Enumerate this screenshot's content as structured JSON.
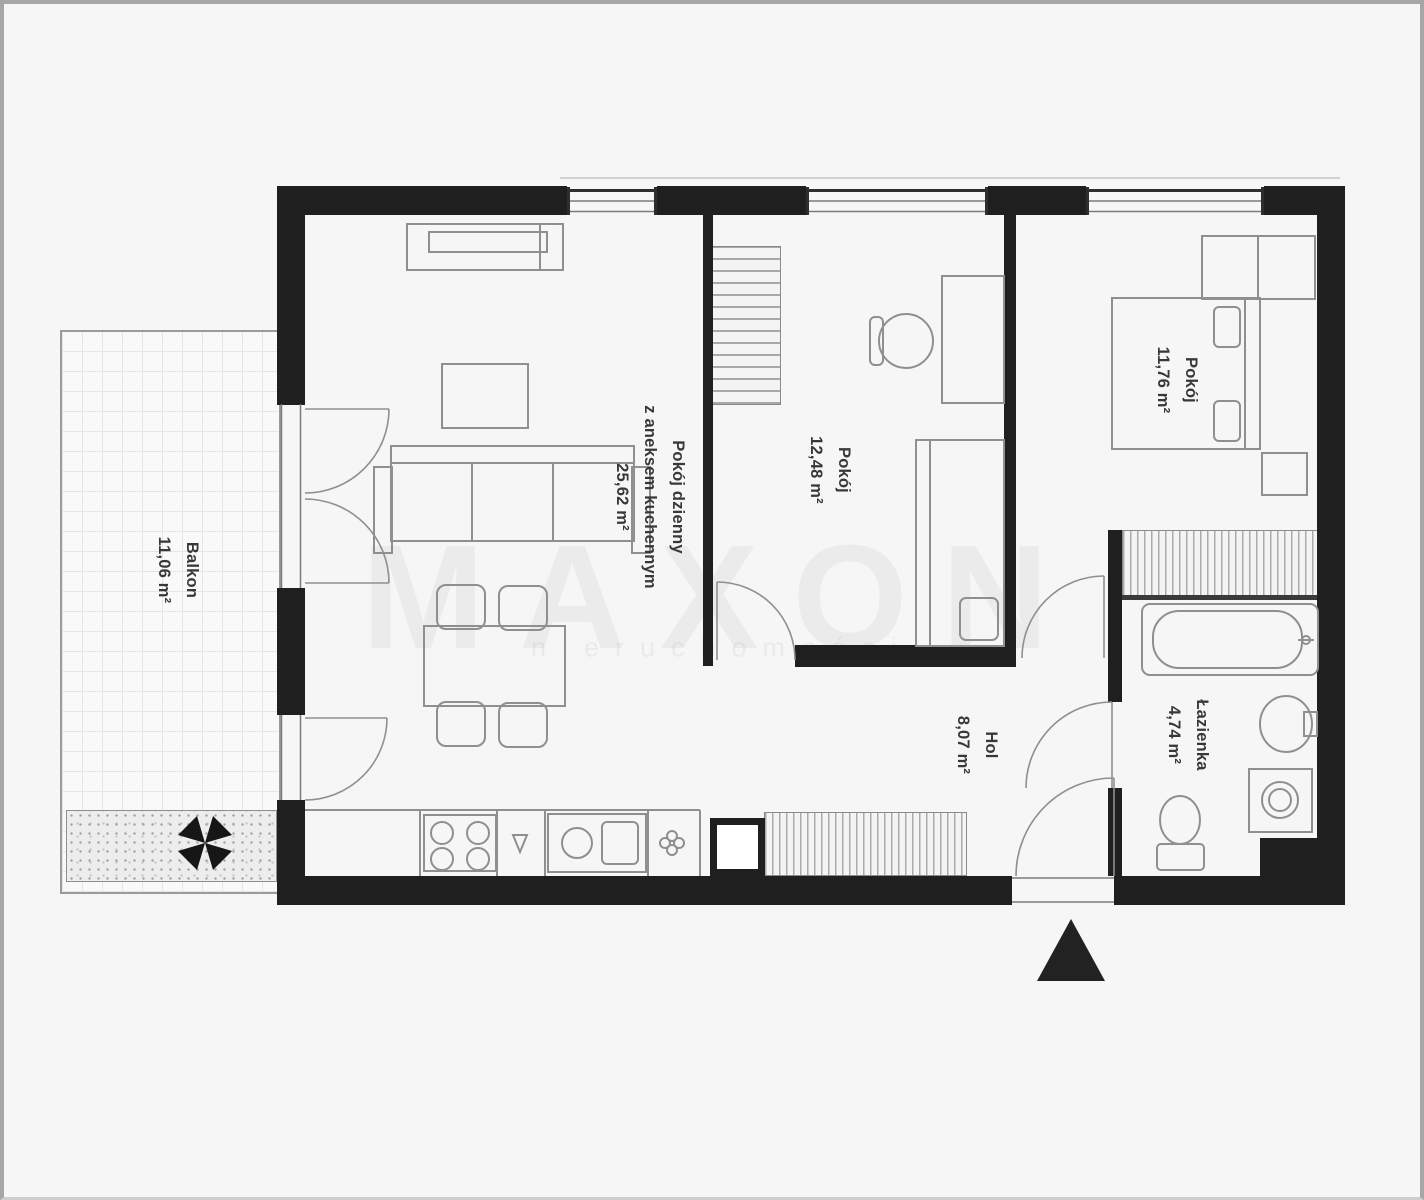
{
  "colors": {
    "wall": "#1f1f1f",
    "furniture_line": "#8f8f8f",
    "label_text": "#383838",
    "frame_border": "#a6a6a6",
    "background": "#f6f6f7"
  },
  "rooms": {
    "living": {
      "line1": "Pokój dzienny",
      "line2": "z aneksem kuchennym",
      "area": "25,62 m²"
    },
    "room2": {
      "line1": "Pokój",
      "area": "12,48 m²"
    },
    "bedroom": {
      "line1": "Pokój",
      "area": "11,76 m²"
    },
    "hall": {
      "line1": "Hol",
      "area": "8,07 m²"
    },
    "bathroom": {
      "line1": "Łazienka",
      "area": "4,74 m²"
    },
    "balcony": {
      "line1": "Balkon",
      "area": "11,06 m²"
    }
  },
  "watermark": {
    "brand": "MAXON",
    "sub": "nieruchomości"
  },
  "icons": {
    "entrance": "entrance-arrow-icon",
    "balcony_fan": "pinwheel-icon"
  }
}
